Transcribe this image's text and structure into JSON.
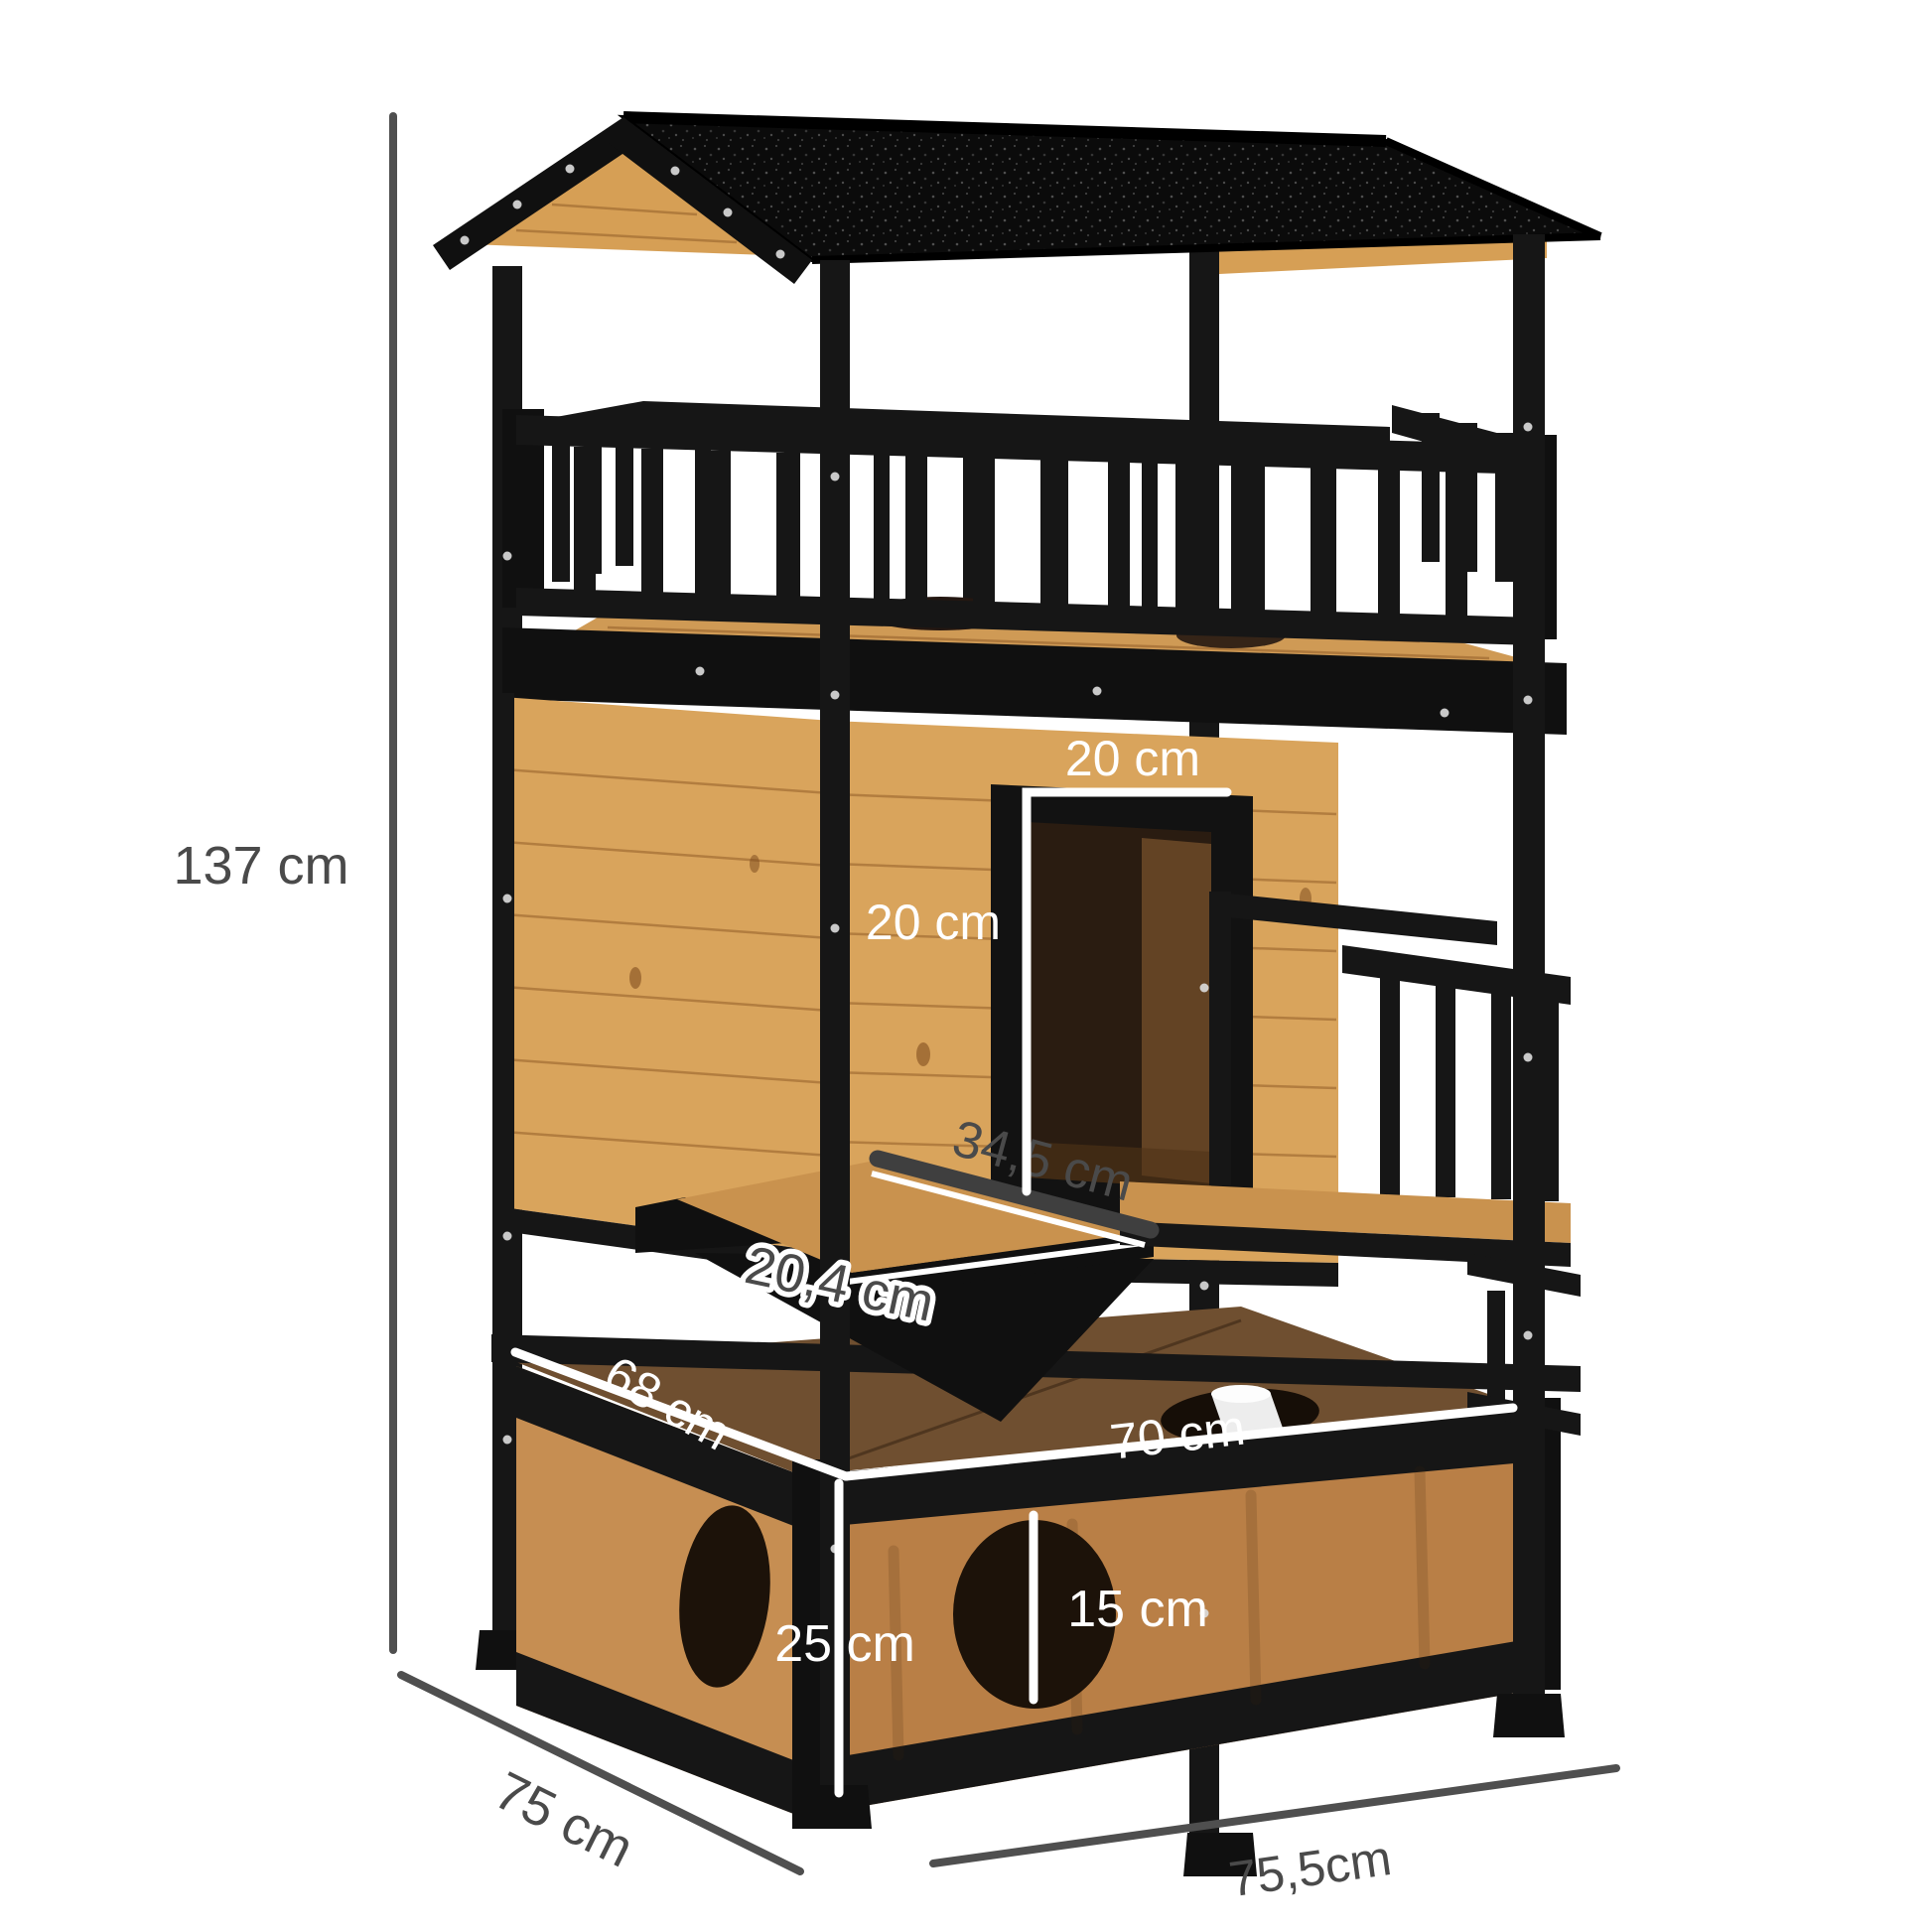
{
  "image": {
    "kind": "product-dimension-diagram",
    "subject": "two-storey wooden outdoor cat house with asphalt roof, balcony, side door and litter box base"
  },
  "labels": {
    "total_height": "137 cm",
    "side_depth": "75 cm",
    "front_width": "75,5cm",
    "door_width": "20 cm",
    "door_height": "20 cm",
    "step_length": "34,5 cm",
    "step_depth": "20,4 cm",
    "base_top_depth": "68 cm",
    "base_top_width": "70 cm",
    "base_height": "25 cm",
    "hole_diameter": "15 cm"
  },
  "colors": {
    "background": "#ffffff",
    "frame_black": "#161616",
    "roof_black": "#0b0b0b",
    "wood_gable": "#d69f55",
    "wood_light": "#d9a45c",
    "balcony_floor": "#cf9a55",
    "platform_wood": "#c9924e",
    "box_top": "#6f4f30",
    "box_front": "#b97f46",
    "box_side": "#c68e52",
    "hole_dark": "#1c1209",
    "interior_dark": "#2a1c11",
    "dimension_dark": "#4a4a4a",
    "dimension_white": "#ffffff",
    "screw": "#d9d9d9"
  }
}
